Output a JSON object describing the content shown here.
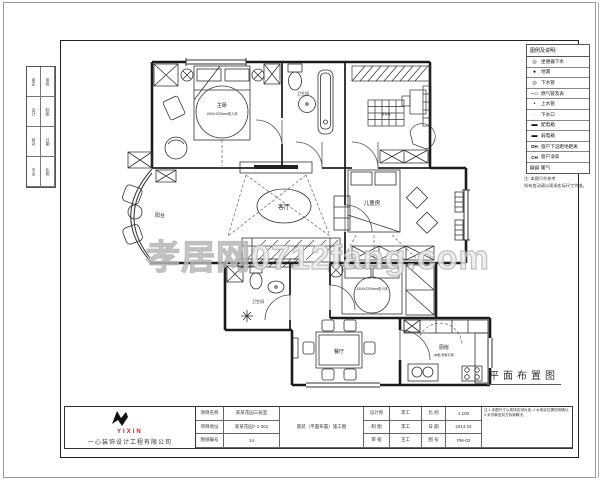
{
  "watermark": {
    "text": "孝居网0712fang.com"
  },
  "plan": {
    "title": "平面布置图",
    "rooms": {
      "master": "主卧",
      "master_size": "1500×2200mm双人床",
      "bath1": "卫生间",
      "mahjong": "麻将桌",
      "balcony": "阳台",
      "living": "客厅",
      "kids": "儿童房",
      "bed2_size": "1500×2200mm双人床",
      "bath2": "卫生间",
      "dining": "餐厅",
      "kitchen": "厨房",
      "kitchen_sub": "(地柜 吊柜示意)"
    }
  },
  "legend": {
    "title": "图例及说明:",
    "items": [
      {
        "glyph": "◎",
        "label": "坐便器下水"
      },
      {
        "glyph": "●",
        "label": "地漏"
      },
      {
        "glyph": "◎",
        "label": "下水管"
      },
      {
        "glyph": "─▭",
        "label": "燃气管及表"
      },
      {
        "glyph": "•",
        "label": "上水管"
      },
      {
        "glyph": "·",
        "label": "下水口"
      },
      {
        "glyph": "▬",
        "label": "配电箱"
      },
      {
        "glyph": "▬",
        "label": "弱电箱"
      },
      {
        "glyph": "DH",
        "label": "窗户下沿距地距离"
      },
      {
        "glyph": "CH",
        "label": "窗户净高"
      },
      {
        "glyph": "▤▤",
        "label": "暖气"
      }
    ],
    "note_mark": "注:",
    "note_line1": "本图只作参考",
    "note_line2": "如有变动请以现场实际尺寸为准。"
  },
  "margin": {
    "labels": [
      "审定",
      "审核",
      "设计",
      "制图",
      "校对",
      "日期",
      "专业",
      "比例"
    ]
  },
  "titleblock": {
    "company": "一心装饰设计工程有限公司",
    "logo_text": "YIXIN",
    "l1": "项目名称",
    "v1": "某某花园三居室",
    "l2": "项目地址",
    "v2": "某某花园7-1-301",
    "l3": "图纸编号",
    "v3": "14",
    "wide": "家装（平面布置）施工图",
    "l4": "设计师",
    "v4": "李工",
    "l5": "比 例",
    "v5": "1:100",
    "l6": "制 图",
    "v6": "李工",
    "l7": "日 期",
    "v7": "2014.04",
    "l8": "审 核",
    "v8": "王工",
    "l9": "图 号",
    "v9": "PM-03",
    "note": "注:1.本图尺寸以现场实测为准; 2.水电定位需现场确认; 3.未尽事宜双方协商解决。"
  }
}
